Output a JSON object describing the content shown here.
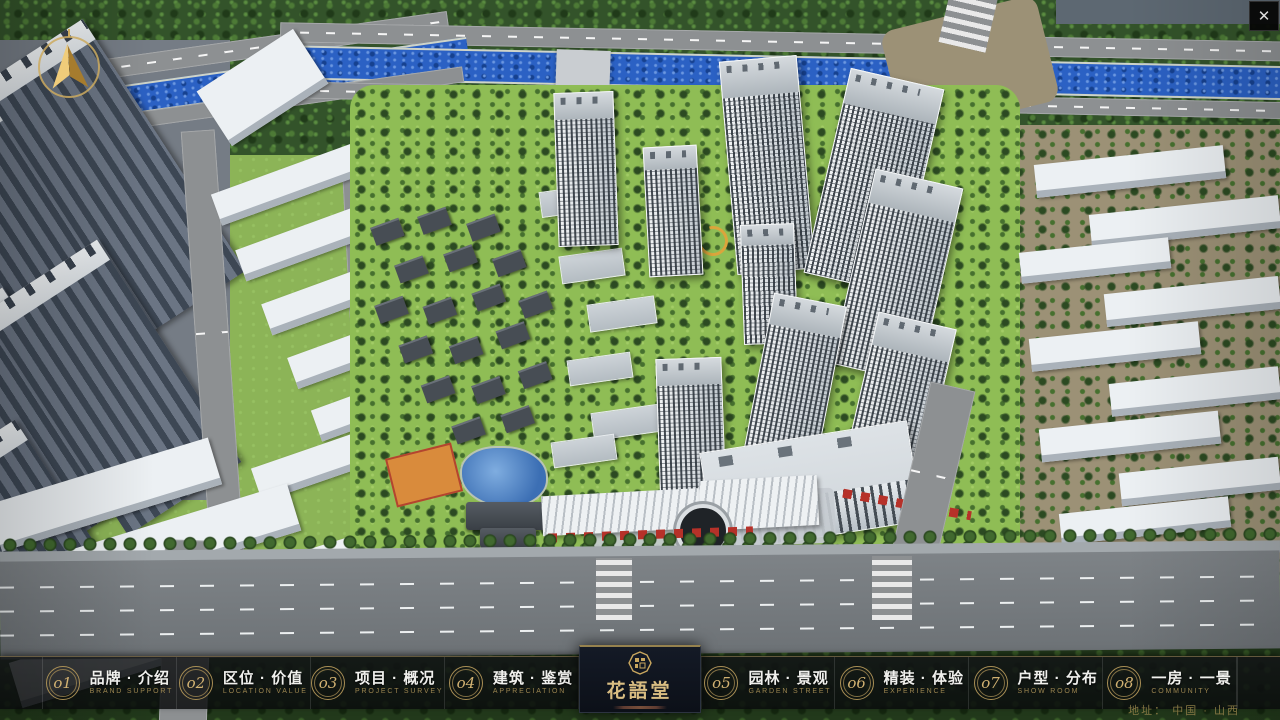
{
  "window": {
    "close_glyph": "✕"
  },
  "menu": {
    "items": [
      {
        "num": "o1",
        "zh": "品牌 · 介绍",
        "en": "BRAND SUPPORT"
      },
      {
        "num": "o2",
        "zh": "区位 · 价值",
        "en": "LOCATION VALUE"
      },
      {
        "num": "o3",
        "zh": "项目 · 概况",
        "en": "PROJECT SURVEY"
      },
      {
        "num": "o4",
        "zh": "建筑 · 鉴赏",
        "en": "APPRECIATION"
      },
      {
        "num": "o5",
        "zh": "园林 · 景观",
        "en": "GARDEN STREET"
      },
      {
        "num": "o6",
        "zh": "精装 · 体验",
        "en": "EXPERIENCE"
      },
      {
        "num": "o7",
        "zh": "户型 · 分布",
        "en": "SHOW ROOM"
      },
      {
        "num": "o8",
        "zh": "一房 · 一景",
        "en": "COMMUNITY"
      }
    ]
  },
  "logo": {
    "title": "花語堂"
  },
  "footer": {
    "address": "地址： 中国 · 山西"
  },
  "colors": {
    "accent_gold": "#c9a75f",
    "bar_background": "rgba(12,14,16,0.84)",
    "river_blue": "#2b61c4",
    "label_white": "#f0f0ed",
    "sub_label_gold": "#9b8550"
  }
}
